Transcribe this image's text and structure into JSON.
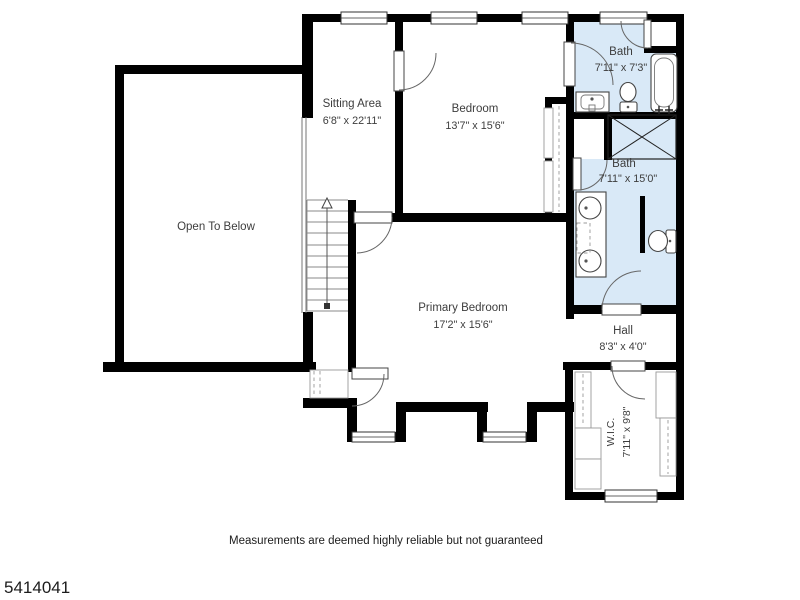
{
  "plan_id": "5414041",
  "disclaimer": "Measurements are deemed highly reliable but not guaranteed",
  "rooms": {
    "open_to_below": {
      "name": "Open To Below"
    },
    "sitting_area": {
      "name": "Sitting Area",
      "dims": "6'8\" x 22'11\""
    },
    "bedroom": {
      "name": "Bedroom",
      "dims": "13'7\" x 15'6\""
    },
    "bath_upper": {
      "name": "Bath",
      "dims": "7'11\" x 7'3\""
    },
    "bath_primary": {
      "name": "Bath",
      "dims": "7'11\" x 15'0\""
    },
    "primary_bedroom": {
      "name": "Primary Bedroom",
      "dims": "17'2\" x 15'6\""
    },
    "hall": {
      "name": "Hall",
      "dims": "8'3\" x 4'0\""
    },
    "walk_in_closet": {
      "name": "W.I.C.",
      "dims": "7'11\" x 9'8\""
    }
  },
  "colors": {
    "wall": "#000000",
    "bath_fill": "#d9e9f7",
    "label": "#3d3d3d"
  }
}
